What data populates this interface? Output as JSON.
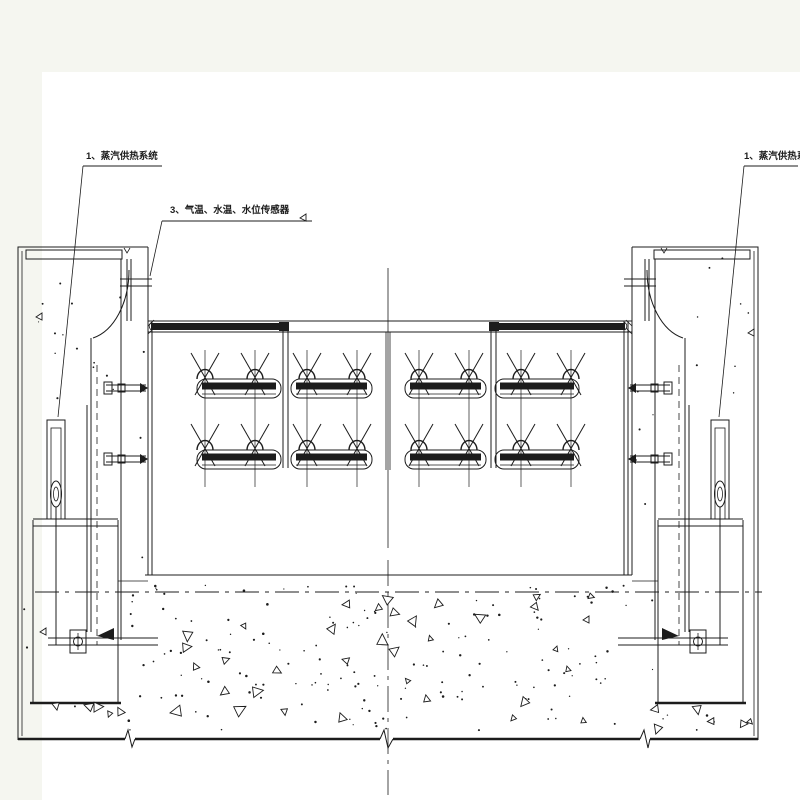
{
  "drawing": {
    "colors": {
      "background": "#f5f6f0",
      "paper": "#ffffff",
      "ink": "#1c1c1c"
    },
    "labels": {
      "steam_left": "1、蒸汽供热系统",
      "sensors": "3、气温、水温、水位传感器",
      "steam_right": "1、蒸汽供热系统"
    }
  }
}
